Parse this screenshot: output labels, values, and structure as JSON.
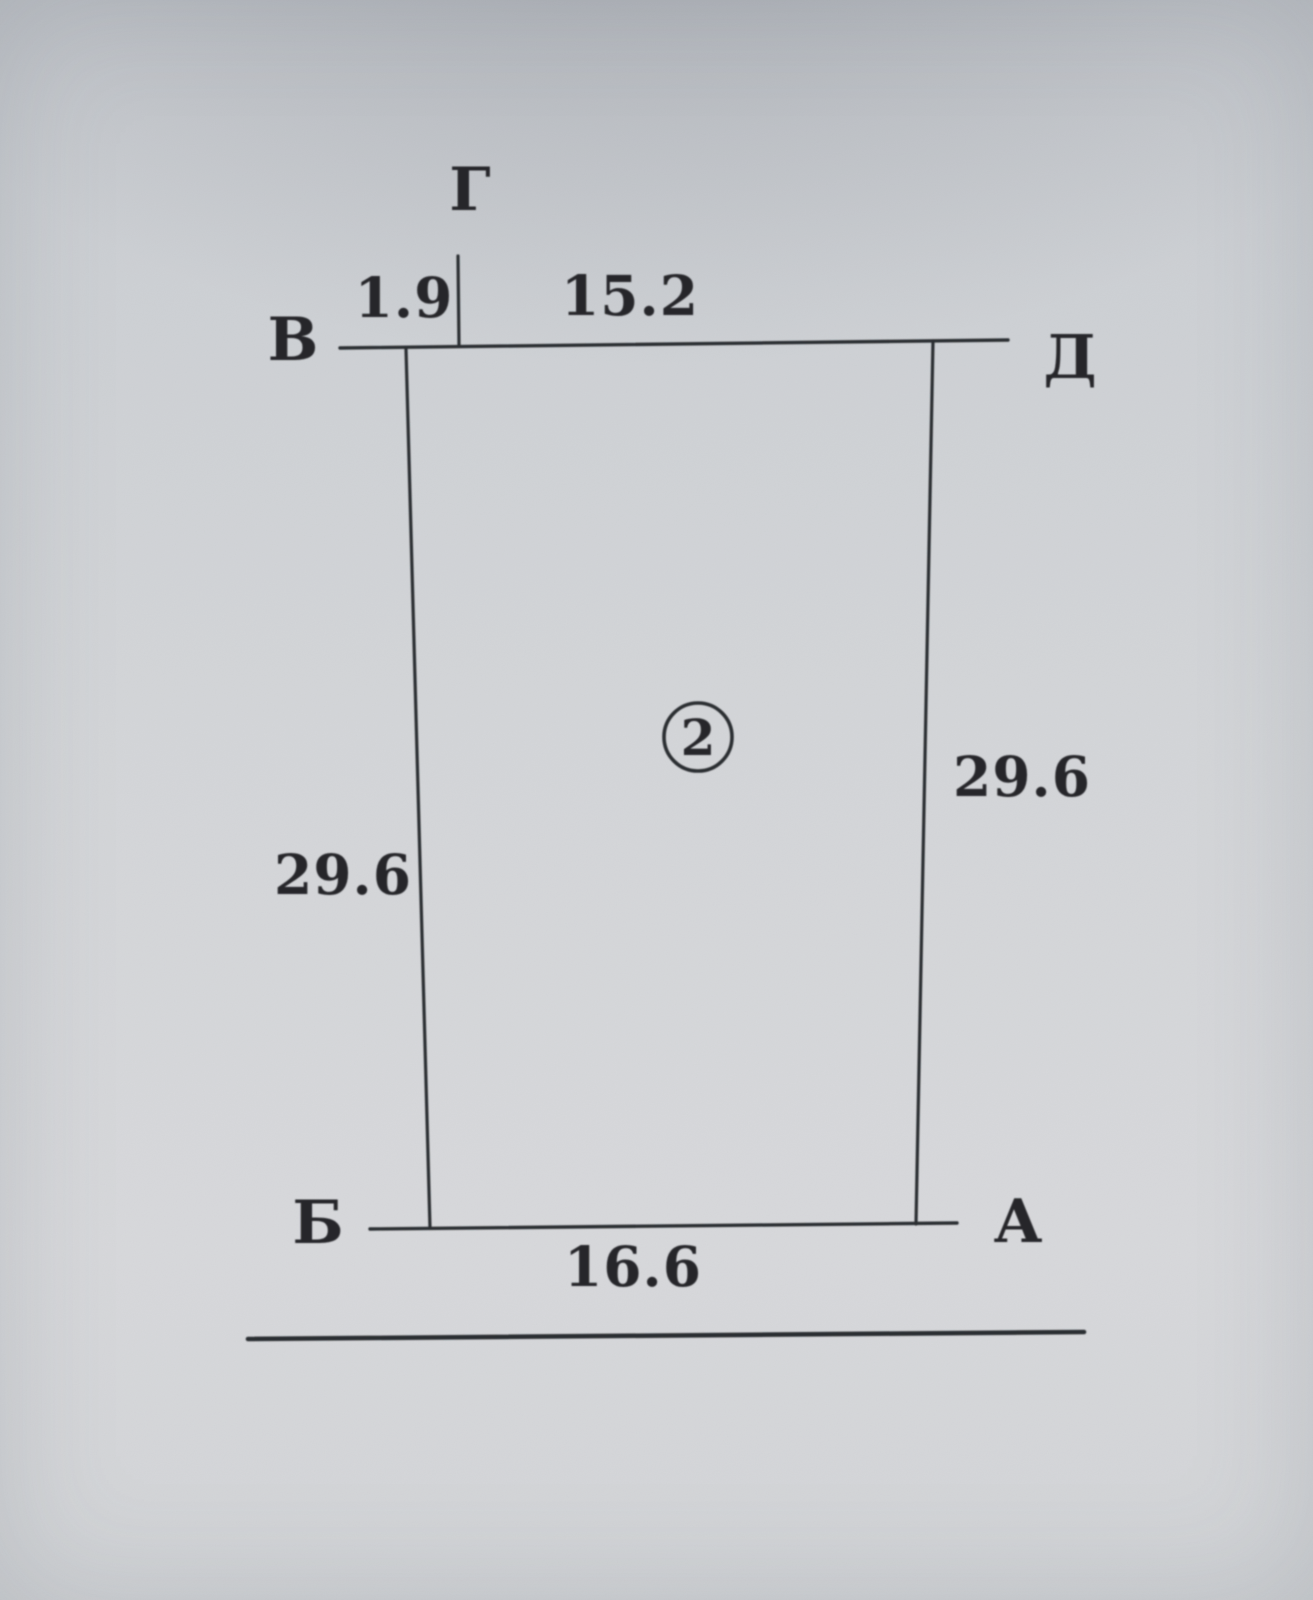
{
  "diagram": {
    "title_hint": "scanned plot sketch",
    "plot_number": "2",
    "points": {
      "top": "Г",
      "left_top": "В",
      "right_top": "Д",
      "left_bottom": "Б",
      "right_bottom": "А"
    },
    "measurements": {
      "top_left_segment": "1.9",
      "top_right_segment": "15.2",
      "left_side": "29.6",
      "right_side": "29.6",
      "bottom_side": "16.6"
    },
    "colors": {
      "ink": "#2c2d30",
      "paper": "#d0d3d6"
    }
  }
}
